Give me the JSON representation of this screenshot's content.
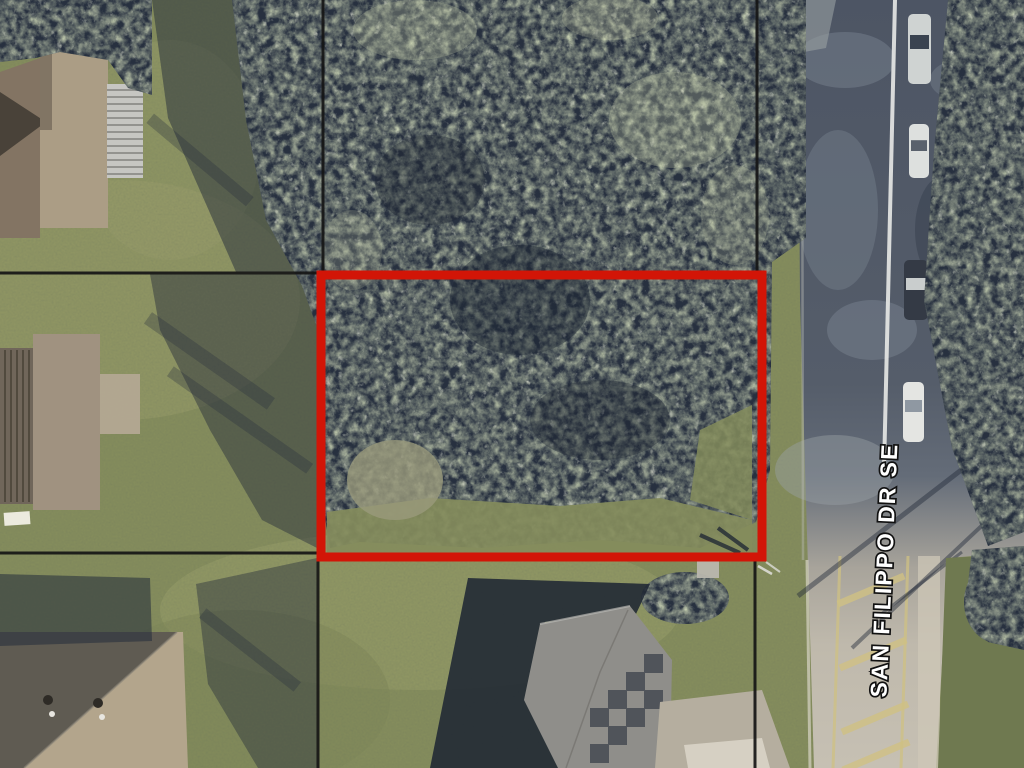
{
  "street_label": {
    "text": "SAN FILIPPO DR SE"
  },
  "colors": {
    "parcel_outline": "#d21507",
    "boundary": "#151515",
    "lawn": "#848c5c",
    "lawn_light": "#979c6a",
    "lawn_dark": "#6f7950",
    "canopy_dark": "#27303f",
    "canopy_mid": "#8b9a6c",
    "canopy_light": "#c7cca9",
    "shadow": "#232b3a",
    "road_shaded": "#4d5564",
    "road_mid": "#646c78",
    "road_sunlit": "#bfb9ac",
    "centerline": "#e8e9e7",
    "hatch_yellow": "#cfc183",
    "sidewalk": "#cdc7b7",
    "roof_tan": "#ab9d85",
    "roof_brown": "#837463",
    "roof_taupe": "#a09280",
    "roof_gray": "#8f8e8a",
    "roof_dark_slope": "#5f5b52",
    "roof_tan2": "#b3a58c",
    "patch_dark": "#4a4e55",
    "driveway": "#b5ae9f",
    "driveway_bright": "#d9d4c6",
    "label_fill": "#ffffff",
    "label_stroke": "#111111"
  },
  "parcel_outline": {
    "x": 321,
    "y": 275,
    "width": 441,
    "height": 282,
    "stroke_width": 9
  },
  "boundary_lines": [
    {
      "x1": 323,
      "y1": 0,
      "x2": 323,
      "y2": 272
    },
    {
      "x1": 0,
      "y1": 273,
      "x2": 318,
      "y2": 273
    },
    {
      "x1": 757,
      "y1": 0,
      "x2": 757,
      "y2": 272
    },
    {
      "x1": 0,
      "y1": 553,
      "x2": 317,
      "y2": 553
    },
    {
      "x1": 318,
      "y1": 561,
      "x2": 318,
      "y2": 768
    },
    {
      "x1": 755,
      "y1": 561,
      "x2": 755,
      "y2": 768
    }
  ],
  "vehicles": [
    {
      "x": 908,
      "y": 14,
      "w": 23,
      "h": 70,
      "body": "#cfd3d2",
      "glass": "#3a4350"
    },
    {
      "x": 909,
      "y": 124,
      "w": 20,
      "h": 54,
      "body": "#dde0de",
      "glass": "#59616c"
    },
    {
      "x": 904,
      "y": 260,
      "w": 24,
      "h": 60,
      "body": "#343a45",
      "glass": "#c9cdcd"
    },
    {
      "x": 903,
      "y": 382,
      "w": 21,
      "h": 60,
      "body": "#e4e5e2",
      "glass": "#8f98a2"
    }
  ],
  "road_markings": {
    "hatch_stripes": [
      {
        "cx": 871,
        "cy": 590
      },
      {
        "cx": 873,
        "cy": 654
      },
      {
        "cx": 875,
        "cy": 718
      },
      {
        "cx": 876,
        "cy": 756
      }
    ],
    "median_lines": [
      {
        "x1": 840,
        "y1": 556,
        "x2": 833,
        "y2": 768
      },
      {
        "x1": 908,
        "y1": 556,
        "x2": 901,
        "y2": 768
      }
    ],
    "pole_shadows": [
      {
        "x1": 1026,
        "y1": 420,
        "x2": 798,
        "y2": 596,
        "w": 5
      },
      {
        "x1": 1026,
        "y1": 484,
        "x2": 852,
        "y2": 648,
        "w": 4
      },
      {
        "x1": 962,
        "y1": 552,
        "x2": 876,
        "y2": 618,
        "w": 3
      }
    ]
  }
}
